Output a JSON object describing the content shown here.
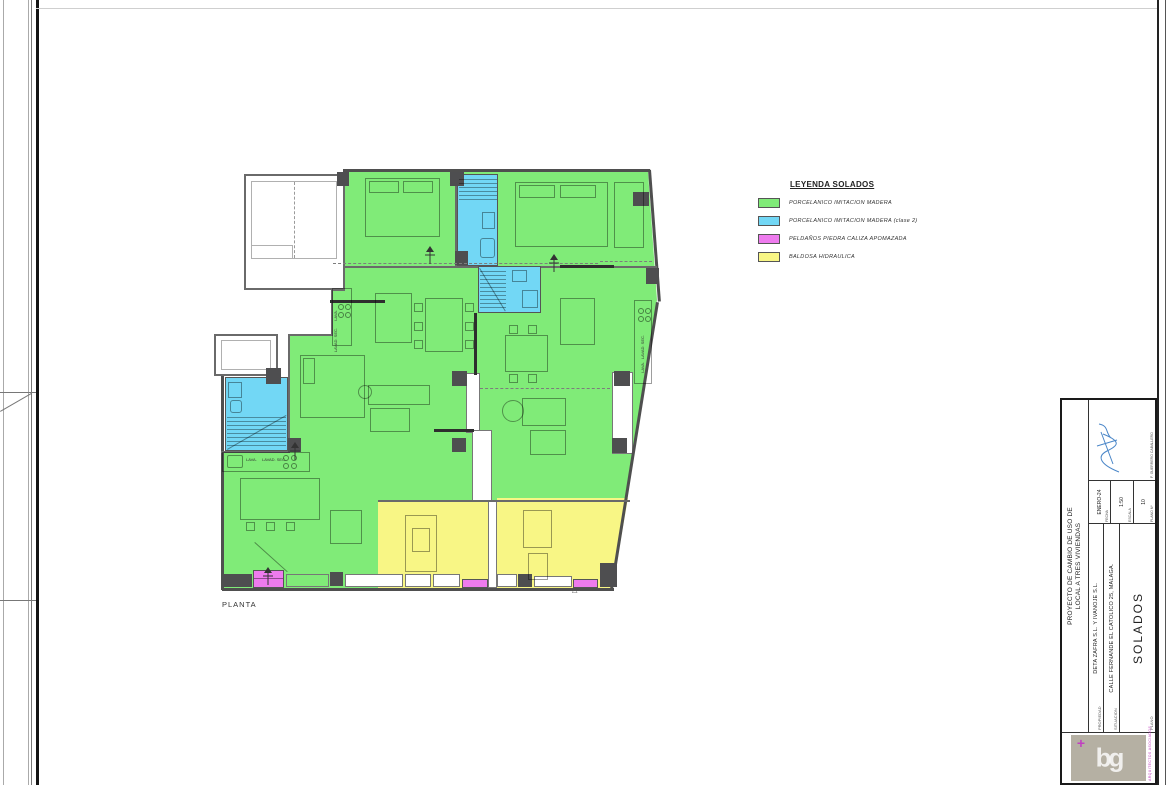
{
  "plan": {
    "label": "PLANTA",
    "entry_mark": "△",
    "labels": {
      "lava": "LAVA.",
      "lavad": "LAVAD. SEC."
    }
  },
  "legend": {
    "title": "LEYENDA SOLADOS",
    "items": [
      {
        "label": "PORCELANICO IMITACION MADERA",
        "color": "#80EB78"
      },
      {
        "label": "PORCELANICO IMITACION MADERA (clase 2)",
        "color": "#72D7F5"
      },
      {
        "label": "PELDAÑOS PIEDRA CALIZA APOMAZADA",
        "color": "#EE7BEE"
      },
      {
        "label": "BALDOSA HIDRAULICA",
        "color": "#F8F685"
      }
    ]
  },
  "title_block": {
    "project_title_line1": "PROYECTO DE CAMBIO DE USO DE",
    "project_title_line2": "LOCAL A TRES VIVIENDAS",
    "fields": [
      {
        "label": "PROPIEDAD",
        "value": "DETA ZAFRA S.L. Y IVANOJE S.L."
      },
      {
        "label": "SITUACION",
        "value": "CALLE FERNANDE EL CATOLICO 25, MALAGA."
      },
      {
        "label": "PLANO",
        "value": "SOLADOS"
      }
    ],
    "meta": [
      {
        "label": "FECHA",
        "value": "ENERO-24"
      },
      {
        "label": "ESCALA",
        "value": "1:50"
      },
      {
        "label": "PLANO Nº",
        "value": "10"
      }
    ],
    "signature_caption": "F. GUERRERO CABALLERO",
    "logo_text": "bg",
    "logo_plus": "+",
    "logo_caption": "ARQUITECTOS ASOCIADOS"
  },
  "colors": {
    "floor_wood": "#80EB78",
    "floor_wood_2": "#72D7F5",
    "steps": "#EE7BEE",
    "hydraulic_tile": "#F8F685",
    "column": "#4e4e50"
  }
}
